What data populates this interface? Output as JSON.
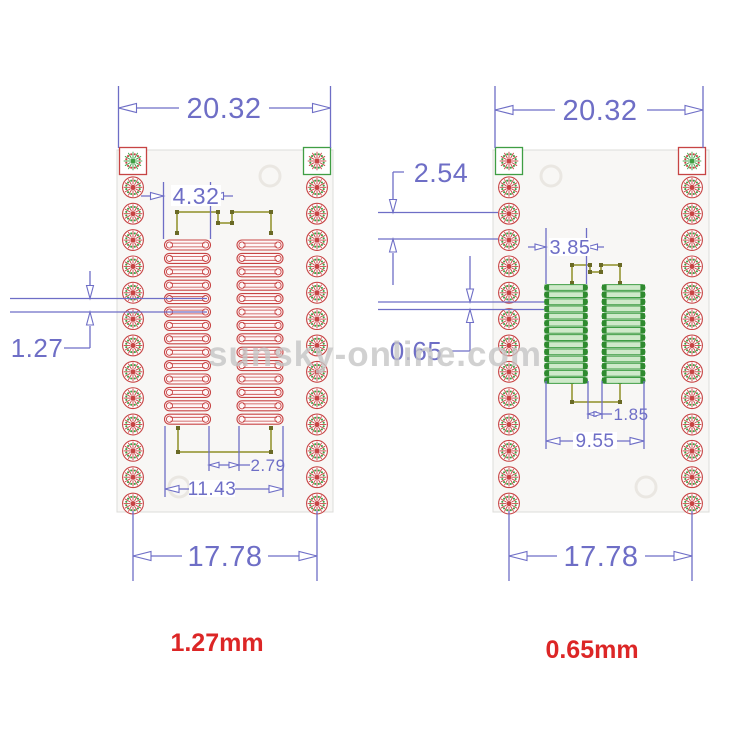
{
  "watermark": {
    "text": "sunsky-online.com",
    "color": "#c6c6c6"
  },
  "boards": {
    "left": {
      "caption": "1.27mm",
      "dims": {
        "top_width": "20.32",
        "col_width": "4.32",
        "pitch": "1.27",
        "pad_gap": "2.79",
        "pad_span": "11.43",
        "row_span": "17.78"
      },
      "through_hole_rows": 14,
      "smd_pad_rows": 14,
      "smd_pad_color": "#c74444"
    },
    "right": {
      "caption": "0.65mm",
      "dims": {
        "top_width": "20.32",
        "hole_pitch": "2.54",
        "col_width": "3.85",
        "pitch": "0.65",
        "pad_gap": "1.85",
        "pad_span": "9.55",
        "row_span": "17.78"
      },
      "through_hole_rows": 14,
      "smd_pad_rows": 14,
      "smd_pad_color": "#3f9e44"
    }
  },
  "colors": {
    "dimension_blue": "#6e6ec6",
    "pad_red": "#c74444",
    "pad_red_center": "#e02020",
    "pad_green": "#3f9e44",
    "pad_green_dark": "#2f8a2f",
    "silkscreen_olive": "#a9a95a",
    "caption_red": "#dc2626"
  }
}
